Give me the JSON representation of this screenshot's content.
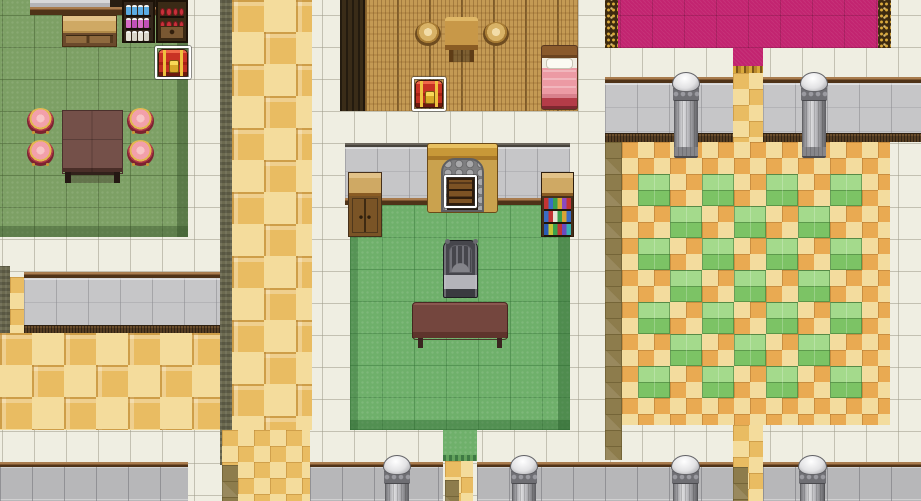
{
  "meta": {
    "description": "Top-down RPG interior tile map with tavern, bedroom, sitting room, pink-carpet hall and checkered ballroom",
    "canvas": {
      "width": 921,
      "height": 501
    },
    "tile_size": 32,
    "grid_offset": {
      "x": 2,
      "y": 15
    }
  },
  "palette": {
    "white_tile": "#efeee2",
    "grass": "#7da065",
    "green": "#6fb06b",
    "wood_floor": "#c49a54",
    "wall_gray": "#c6c6c8",
    "trim_brown": "#4f3318",
    "gold_light": "#f4dc9c",
    "gold_dark": "#e9bc62",
    "olive_shadow": "#8d7c4c",
    "checker_cream": "#f3dc9e",
    "checker_orange": "#e9aa52",
    "checker_green_light": "#a4da8c",
    "checker_green_dark": "#7cc365",
    "carpet_pink": "#c22470",
    "carpet_gold": "#d9a93c",
    "selection_white": "#ffffff",
    "chest_red": "#c83224",
    "chest_gold": "#eec23e",
    "stool_pink": "#f2a0aa",
    "pillar_gray": "#6f6f74"
  },
  "regions": [
    {
      "name": "floor-white-base",
      "type": "white",
      "x": 0,
      "y": 0,
      "w": 921,
      "h": 501
    },
    {
      "name": "floor-grass-tavern",
      "type": "grass",
      "x": 0,
      "y": 0,
      "w": 188,
      "h": 237
    },
    {
      "name": "tavern-wall-cap",
      "type": "graycap",
      "x": 30,
      "y": 0,
      "w": 80,
      "h": 13
    },
    {
      "name": "tavern-wall-dark",
      "type": "darkbar",
      "x": 110,
      "y": 0,
      "w": 78,
      "h": 7
    },
    {
      "name": "tavern-wall-trim",
      "type": "trim",
      "x": 30,
      "y": 7,
      "w": 158,
      "h": 8
    },
    {
      "name": "hall-left-trim",
      "type": "trim",
      "x": 24,
      "y": 272,
      "w": 198,
      "h": 6
    },
    {
      "name": "hall-left-wall",
      "type": "wallgray",
      "x": 24,
      "y": 278,
      "w": 198,
      "h": 47
    },
    {
      "name": "hall-left-ledge",
      "type": "ledge",
      "x": 24,
      "y": 325,
      "w": 198,
      "h": 9
    },
    {
      "name": "hall-left-edge-shadow",
      "type": "dkolive",
      "x": 0,
      "y": 266,
      "w": 10,
      "h": 67
    },
    {
      "name": "hall-left-edge-gold",
      "type": "gold16",
      "x": 10,
      "y": 277,
      "w": 14,
      "h": 56
    },
    {
      "name": "floor-gold-lower-left",
      "type": "gold32",
      "x": 0,
      "y": 333,
      "w": 222,
      "h": 97
    },
    {
      "name": "corridor-shadow-strip",
      "type": "dkolive",
      "x": 220,
      "y": 0,
      "w": 12,
      "h": 465
    },
    {
      "name": "corridor-gold",
      "type": "gold32",
      "x": 232,
      "y": 0,
      "w": 80,
      "h": 430
    },
    {
      "name": "corridor-gold-lower",
      "type": "gold16",
      "x": 222,
      "y": 430,
      "w": 88,
      "h": 71
    },
    {
      "name": "corridor-olive-lower",
      "type": "olive",
      "x": 222,
      "y": 465,
      "w": 16,
      "h": 36
    },
    {
      "name": "wood-room-left-wall",
      "type": "woodwall",
      "x": 340,
      "y": 0,
      "w": 25,
      "h": 111
    },
    {
      "name": "floor-wood-room",
      "type": "wood",
      "x": 365,
      "y": 0,
      "w": 213,
      "h": 111
    },
    {
      "name": "center-wall-topline",
      "type": "walltop",
      "x": 345,
      "y": 143,
      "w": 225,
      "h": 5
    },
    {
      "name": "center-wall-face",
      "type": "wallgray",
      "x": 345,
      "y": 147,
      "w": 225,
      "h": 51
    },
    {
      "name": "center-wall-trim",
      "type": "trim",
      "x": 345,
      "y": 198,
      "w": 225,
      "h": 7
    },
    {
      "name": "floor-green-room",
      "type": "green",
      "x": 350,
      "y": 205,
      "w": 220,
      "h": 225
    },
    {
      "name": "green-doorway",
      "type": "greendoor",
      "x": 443,
      "y": 430,
      "w": 34,
      "h": 31
    },
    {
      "name": "green-doorway-gold",
      "type": "gold16",
      "x": 445,
      "y": 461,
      "w": 28,
      "h": 40
    },
    {
      "name": "green-doorway-olive",
      "type": "olive",
      "x": 445,
      "y": 480,
      "w": 14,
      "h": 21
    },
    {
      "name": "carpet-border-left",
      "type": "goldborder",
      "x": 605,
      "y": 0,
      "w": 13,
      "h": 48
    },
    {
      "name": "carpet-pink",
      "type": "pink",
      "x": 618,
      "y": 0,
      "w": 260,
      "h": 48
    },
    {
      "name": "carpet-border-right",
      "type": "goldborder",
      "x": 878,
      "y": 0,
      "w": 13,
      "h": 48
    },
    {
      "name": "carpet-doorway",
      "type": "pinkdoor",
      "x": 733,
      "y": 48,
      "w": 30,
      "h": 25
    },
    {
      "name": "right-wall-trim-a",
      "type": "trim",
      "x": 605,
      "y": 77,
      "w": 128,
      "h": 6
    },
    {
      "name": "right-wall-trim-b",
      "type": "trim",
      "x": 763,
      "y": 77,
      "w": 158,
      "h": 6
    },
    {
      "name": "right-wall-face-a",
      "type": "wallgray",
      "x": 605,
      "y": 83,
      "w": 128,
      "h": 50
    },
    {
      "name": "right-wall-face-b",
      "type": "wallgray",
      "x": 763,
      "y": 83,
      "w": 158,
      "h": 50
    },
    {
      "name": "right-wall-ledge-a",
      "type": "ledge",
      "x": 605,
      "y": 133,
      "w": 128,
      "h": 9
    },
    {
      "name": "right-wall-ledge-b",
      "type": "ledge",
      "x": 763,
      "y": 133,
      "w": 158,
      "h": 9
    },
    {
      "name": "right-doorway-gold",
      "type": "gold16",
      "x": 733,
      "y": 73,
      "w": 30,
      "h": 69
    },
    {
      "name": "checker-room-shadow",
      "type": "olive",
      "x": 605,
      "y": 142,
      "w": 17,
      "h": 318
    },
    {
      "name": "floor-checker-room",
      "type": "checkbase",
      "x": 622,
      "y": 142,
      "w": 268,
      "h": 283
    },
    {
      "name": "bottom-doorway-gold-right",
      "type": "gold16",
      "x": 733,
      "y": 425,
      "w": 30,
      "h": 76
    },
    {
      "name": "bottom-doorway-olive-right",
      "type": "olive",
      "x": 733,
      "y": 467,
      "w": 15,
      "h": 34
    },
    {
      "name": "bottom-wall-trim-1",
      "type": "trim",
      "x": 0,
      "y": 462,
      "w": 188,
      "h": 5
    },
    {
      "name": "bottom-wall-face-1",
      "type": "wallgrayb",
      "x": 0,
      "y": 467,
      "w": 188,
      "h": 34
    },
    {
      "name": "bottom-wall-trim-2",
      "type": "trim",
      "x": 310,
      "y": 462,
      "w": 133,
      "h": 5
    },
    {
      "name": "bottom-wall-face-2",
      "type": "wallgrayb",
      "x": 310,
      "y": 467,
      "w": 133,
      "h": 34
    },
    {
      "name": "bottom-wall-trim-3",
      "type": "trim",
      "x": 477,
      "y": 462,
      "w": 256,
      "h": 5
    },
    {
      "name": "bottom-wall-face-3",
      "type": "wallgrayb",
      "x": 477,
      "y": 467,
      "w": 256,
      "h": 34
    },
    {
      "name": "bottom-wall-trim-4",
      "type": "trim",
      "x": 763,
      "y": 462,
      "w": 158,
      "h": 5
    },
    {
      "name": "bottom-wall-face-4",
      "type": "wallgrayb",
      "x": 763,
      "y": 467,
      "w": 158,
      "h": 34
    }
  ],
  "checker_pattern": {
    "room_region": "floor-checker-room",
    "subtile": 16,
    "block_size": 32,
    "mod": 4,
    "block_offsets": [
      [
        1,
        2
      ],
      [
        3,
        0
      ]
    ],
    "min_row": 2
  },
  "objects": [
    {
      "name": "shop-counter",
      "type": "counter",
      "x": 62,
      "y": 15,
      "w": 55,
      "h": 32,
      "interactable": false
    },
    {
      "name": "potion-shelf",
      "type": "bottleshelf",
      "x": 122,
      "y": 0,
      "w": 33,
      "h": 43,
      "interactable": false,
      "rows": [
        [
          "#5aabe2",
          "#5aabe2",
          "#5aabe2",
          "#5aabe2"
        ],
        [
          "#d66cc8",
          "#c050b8",
          "#d66cc8",
          "#c050b8"
        ],
        [
          "#e6e2d6",
          "#d8d4c8",
          "#e6e2d6",
          "#d8d4c8"
        ]
      ]
    },
    {
      "name": "goods-shelf",
      "type": "berryshelf",
      "x": 156,
      "y": 0,
      "w": 32,
      "h": 43,
      "interactable": false,
      "rows": [
        [
          "#c8303a",
          "#c8303a",
          "#c8303a",
          "#c8303a"
        ],
        [
          "#c8303a",
          "#c8303a",
          "#c8303a",
          "#c8303a"
        ]
      ]
    },
    {
      "name": "chest-tavern",
      "type": "chest",
      "x": 158,
      "y": 49,
      "w": 30,
      "h": 28,
      "interactable": true
    },
    {
      "name": "selection-chest-tavern",
      "type": "sel",
      "x": 155,
      "y": 46,
      "w": 36,
      "h": 33,
      "interactable": false
    },
    {
      "name": "tavern-table",
      "type": "tabledark",
      "x": 62,
      "y": 110,
      "w": 61,
      "h": 75,
      "interactable": false
    },
    {
      "name": "stool-pink-1",
      "type": "stoolpink",
      "x": 27,
      "y": 108,
      "w": 27,
      "h": 26,
      "interactable": false
    },
    {
      "name": "stool-pink-2",
      "type": "stoolpink",
      "x": 127,
      "y": 108,
      "w": 27,
      "h": 26,
      "interactable": false
    },
    {
      "name": "stool-pink-3",
      "type": "stoolpink",
      "x": 27,
      "y": 140,
      "w": 27,
      "h": 26,
      "interactable": false
    },
    {
      "name": "stool-pink-4",
      "type": "stoolpink",
      "x": 127,
      "y": 140,
      "w": 27,
      "h": 26,
      "interactable": false
    },
    {
      "name": "wood-room-table",
      "type": "tablesmall",
      "x": 445,
      "y": 17,
      "w": 33,
      "h": 45,
      "interactable": false
    },
    {
      "name": "wood-stool-1",
      "type": "stoolwood",
      "x": 415,
      "y": 22,
      "w": 26,
      "h": 24,
      "interactable": false
    },
    {
      "name": "wood-stool-2",
      "type": "stoolwood",
      "x": 483,
      "y": 22,
      "w": 26,
      "h": 24,
      "interactable": false
    },
    {
      "name": "chest-wood-room",
      "type": "chest",
      "x": 415,
      "y": 80,
      "w": 28,
      "h": 28,
      "interactable": true
    },
    {
      "name": "selection-chest-wood-room",
      "type": "sel",
      "x": 412,
      "y": 77,
      "w": 34,
      "h": 34,
      "interactable": false
    },
    {
      "name": "bed",
      "type": "bed",
      "x": 541,
      "y": 45,
      "w": 37,
      "h": 65,
      "interactable": false
    },
    {
      "name": "fireplace",
      "type": "fireplace",
      "x": 427,
      "y": 143,
      "w": 71,
      "h": 70,
      "interactable": false
    },
    {
      "name": "fireplace-barrel",
      "type": "barrel",
      "x": 447,
      "y": 178,
      "w": 27,
      "h": 27,
      "interactable": true
    },
    {
      "name": "selection-barrel",
      "type": "sel",
      "x": 444,
      "y": 175,
      "w": 33,
      "h": 33,
      "interactable": false
    },
    {
      "name": "cabinet",
      "type": "cabinet",
      "x": 348,
      "y": 172,
      "w": 34,
      "h": 65,
      "interactable": false
    },
    {
      "name": "bookshelf",
      "type": "bookshelf",
      "x": 541,
      "y": 172,
      "w": 33,
      "h": 65,
      "interactable": false,
      "rows": [
        [
          "#c23434",
          "#3a6cc4",
          "#3aa04c",
          "#d8a434",
          "#8a4ac0",
          "#c23434"
        ],
        [
          "#3a6cc4",
          "#c23434",
          "#e8e4d8",
          "#3aa04c",
          "#d8a434",
          "#3a6cc4"
        ],
        [
          "#2a5cb4",
          "#c8c434",
          "#3aa04c",
          "#c23434",
          "#6a4ac0",
          "#38b0b0"
        ]
      ]
    },
    {
      "name": "iron-chair",
      "type": "chairmetal",
      "x": 443,
      "y": 240,
      "w": 35,
      "h": 58,
      "interactable": false
    },
    {
      "name": "green-room-table",
      "type": "bench",
      "x": 412,
      "y": 302,
      "w": 96,
      "h": 48,
      "interactable": false
    },
    {
      "name": "pillar-mid-1",
      "type": "pillar",
      "x": 672,
      "y": 72,
      "w": 28,
      "h": 86,
      "interactable": false
    },
    {
      "name": "pillar-mid-2",
      "type": "pillar",
      "x": 800,
      "y": 72,
      "w": 28,
      "h": 86,
      "interactable": false
    },
    {
      "name": "pillar-bottom-1",
      "type": "pillar",
      "x": 383,
      "y": 455,
      "w": 28,
      "h": 70,
      "interactable": false
    },
    {
      "name": "pillar-bottom-2",
      "type": "pillar",
      "x": 510,
      "y": 455,
      "w": 28,
      "h": 70,
      "interactable": false
    },
    {
      "name": "pillar-bottom-3",
      "type": "pillar",
      "x": 671,
      "y": 455,
      "w": 29,
      "h": 70,
      "interactable": false
    },
    {
      "name": "pillar-bottom-4",
      "type": "pillar",
      "x": 798,
      "y": 455,
      "w": 29,
      "h": 70,
      "interactable": false
    }
  ]
}
